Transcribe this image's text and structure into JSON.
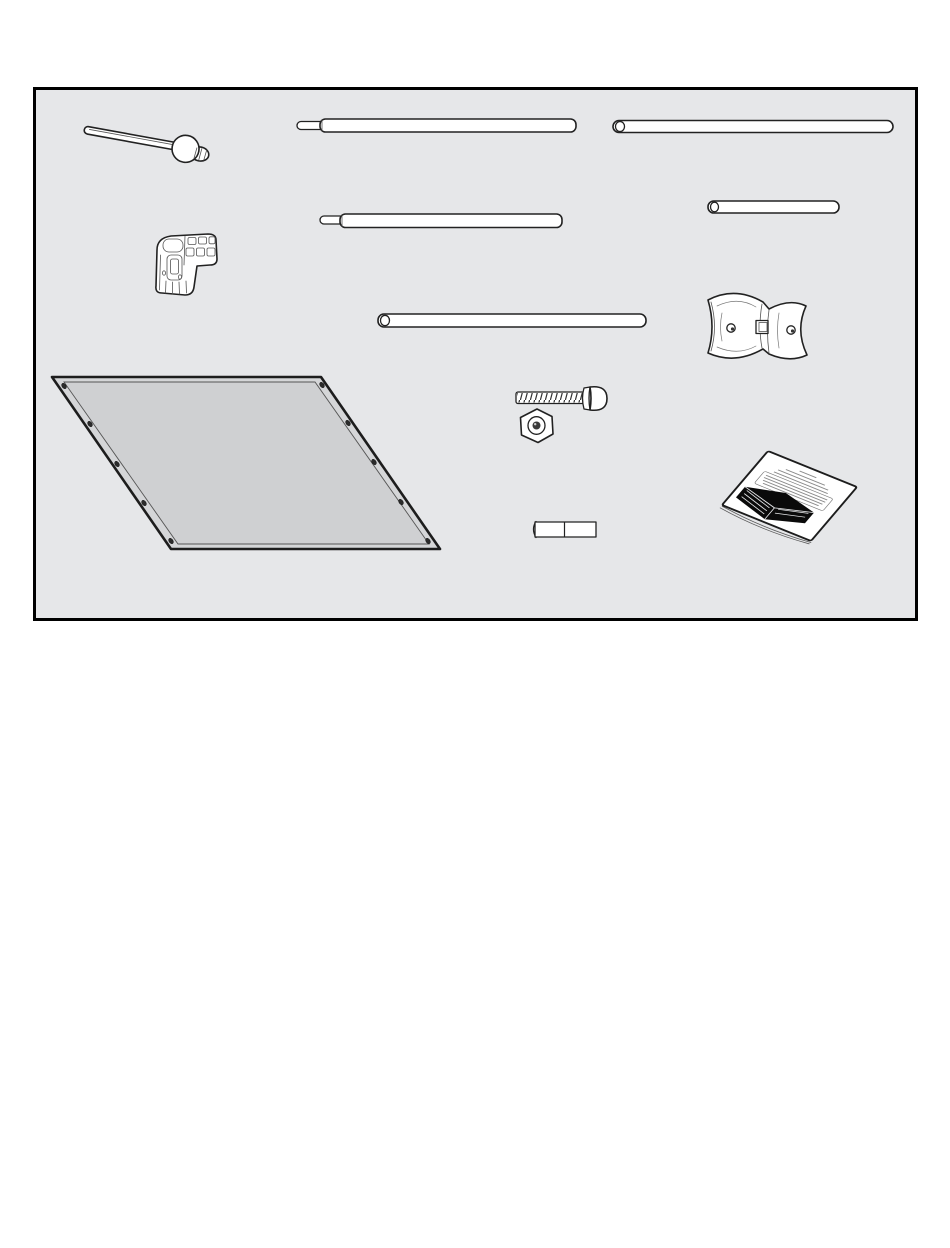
{
  "page": {
    "kind": "assembly-manual-parts-diagram",
    "background": "#ffffff"
  },
  "parts_box": {
    "fill": "#e6e7e9",
    "border_color": "#000000"
  },
  "colors": {
    "line": "#222222",
    "part_fill": "#ffffff",
    "panel_fill": "#d5d6d8",
    "panel_inner_fill": "#cfd0d2",
    "grommet": "#2b2b2b",
    "booklet_cover": "#ffffff",
    "booklet_graphic": "#0a0a0a",
    "booklet_text_scribble": "#8a8a8a"
  },
  "parts": [
    {
      "name": "ball-end-rod"
    },
    {
      "name": "long-pole-with-swaged-tip"
    },
    {
      "name": "long-pole"
    },
    {
      "name": "short-pole"
    },
    {
      "name": "medium-pole-with-swaged-tip"
    },
    {
      "name": "elbow-connector"
    },
    {
      "name": "medium-pole"
    },
    {
      "name": "saddle-bracket"
    },
    {
      "name": "fabric-panel-with-grommets"
    },
    {
      "name": "carriage-bolt"
    },
    {
      "name": "hex-nut"
    },
    {
      "name": "spacer-tube"
    },
    {
      "name": "instruction-booklet"
    }
  ],
  "booklet": {
    "has_legible_text": false,
    "cover_text_lines": 8,
    "grommet_count_left": 5,
    "grommet_count_right": 5
  }
}
